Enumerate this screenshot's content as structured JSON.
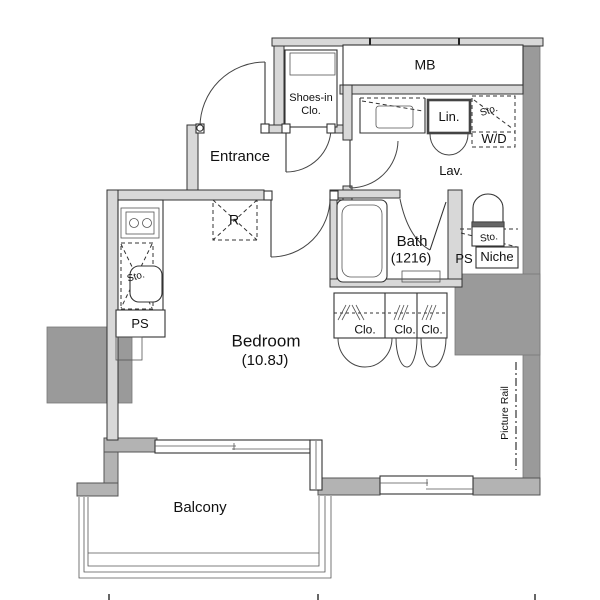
{
  "meta": {
    "type": "apartment-floor-plan-diagram"
  },
  "colors": {
    "wall_light": "#d8d8d8",
    "wall_mid": "#b3b3b3",
    "wall_dark": "#9a9a9a",
    "line": "#333333",
    "bg": "#ffffff"
  },
  "labels": {
    "mb": "MB",
    "shoes_line1": "Shoes-in",
    "shoes_line2": "Clo.",
    "entrance": "Entrance",
    "lin": "Lin.",
    "wd_sto": "Sto.",
    "wd": "W/D",
    "lav": "Lav.",
    "bath": "Bath",
    "bath_size": "(1216)",
    "toilet_sto": "Sto.",
    "ps_right": "PS",
    "niche": "Niche",
    "fridge": "R",
    "kitchen_sto": "Sto.",
    "ps_left": "PS",
    "clo_1": "Clo.",
    "clo_2": "Clo.",
    "clo_3": "Clo.",
    "bedroom": "Bedroom",
    "bedroom_size": "(10.8J)",
    "picture_rail": "Picture Rail",
    "balcony": "Balcony"
  }
}
